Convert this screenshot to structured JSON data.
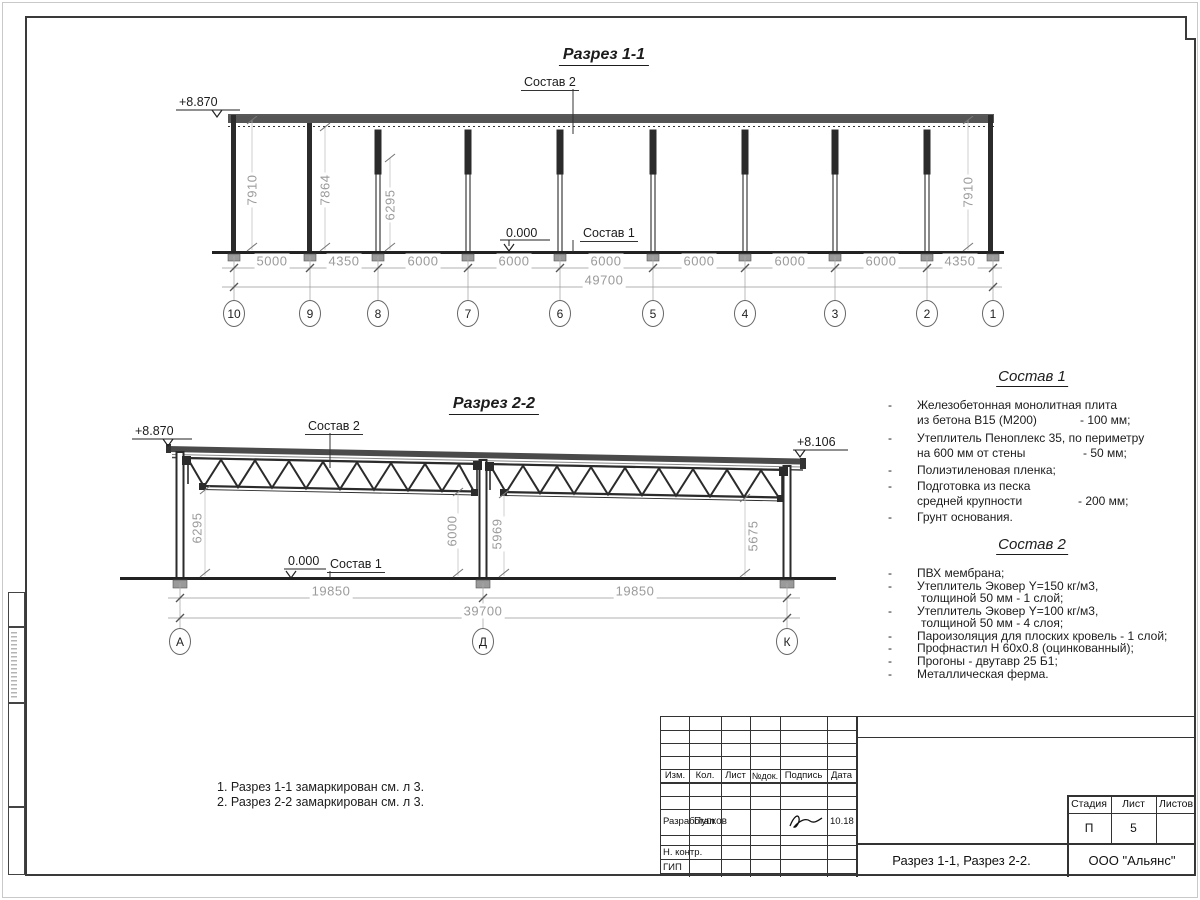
{
  "section1": {
    "title": "Разрез 1-1",
    "level_top": "+8.870",
    "level_zero": "0.000",
    "label_sostav2": "Состав 2",
    "label_sostav1": "Состав 1",
    "heights": [
      "7910",
      "7864",
      "6295",
      "7910"
    ],
    "dims": [
      "5000",
      "4350",
      "6000",
      "6000",
      "6000",
      "6000",
      "6000",
      "6000",
      "4350"
    ],
    "total": "49700",
    "axes": [
      "10",
      "9",
      "8",
      "7",
      "6",
      "5",
      "4",
      "3",
      "2",
      "1"
    ]
  },
  "section2": {
    "title": "Разрез 2-2",
    "level_left": "+8.870",
    "level_right": "+8.106",
    "level_zero": "0.000",
    "label_sostav2": "Состав 2",
    "label_sostav1": "Состав 1",
    "heights": [
      "6295",
      "6000",
      "5969",
      "5675"
    ],
    "dims": [
      "19850",
      "19850"
    ],
    "total": "39700",
    "axes": [
      "А",
      "Д",
      "К"
    ]
  },
  "sostav1": {
    "title": "Состав 1",
    "items": [
      {
        "l1": "Железобетонная  монолитная плита",
        "l2": "из бетона В15 (М200)",
        "v": "- 100 мм;"
      },
      {
        "l1": "Утеплитель Пеноплекс 35, по периметру",
        "l2": "на 600 мм от стены",
        "v": "- 50 мм;"
      },
      {
        "l1": "Полиэтиленовая пленка;"
      },
      {
        "l1": "Подготовка из песка",
        "l2": "средней крупности",
        "v": "- 200 мм;"
      },
      {
        "l1": "Грунт основания."
      }
    ]
  },
  "sostav2": {
    "title": "Состав 2",
    "items": [
      {
        "l1": "ПВХ мембрана;"
      },
      {
        "l1": "Утеплитель Эковер Y=150 кг/м3,",
        "l2": "толщиной 50 мм - 1 слой;"
      },
      {
        "l1": "Утеплитель Эковер Y=100 кг/м3,",
        "l2": "толщиной 50 мм - 4 слоя;"
      },
      {
        "l1": "Пароизоляция для плоских кровель - 1 слой;"
      },
      {
        "l1": "Профнастил Н 60х0.8 (оцинкованный);"
      },
      {
        "l1": "Прогоны - двутавр 25 Б1;"
      },
      {
        "l1": "Металлическая ферма."
      }
    ]
  },
  "notes": {
    "line1": "1. Разрез 1-1 замаркирован см. л 3.",
    "line2": "2. Разрез 2-2 замаркирован см. л 3."
  },
  "titleblock": {
    "headers": [
      "Изм.",
      "Кол.",
      "Лист",
      "№док.",
      "Подпись",
      "Дата"
    ],
    "developed_label": "Разработал",
    "developed_name": "Пупков",
    "developed_date": "10.18",
    "ncontr_label": "Н. контр.",
    "gip_label": "ГИП",
    "stage_label": "Стадия",
    "stage_value": "П",
    "sheet_label": "Лист",
    "sheet_value": "5",
    "sheets_label": "Листов",
    "sheets_value": "",
    "doc_title": "Разрез 1-1, Разрез 2-2.",
    "company": "ООО \"Альянс\""
  },
  "colors": {
    "line_dark": "#2b2b2b",
    "dim_gray": "#9b9b9b",
    "roof_fill": "#4a4a4a"
  }
}
